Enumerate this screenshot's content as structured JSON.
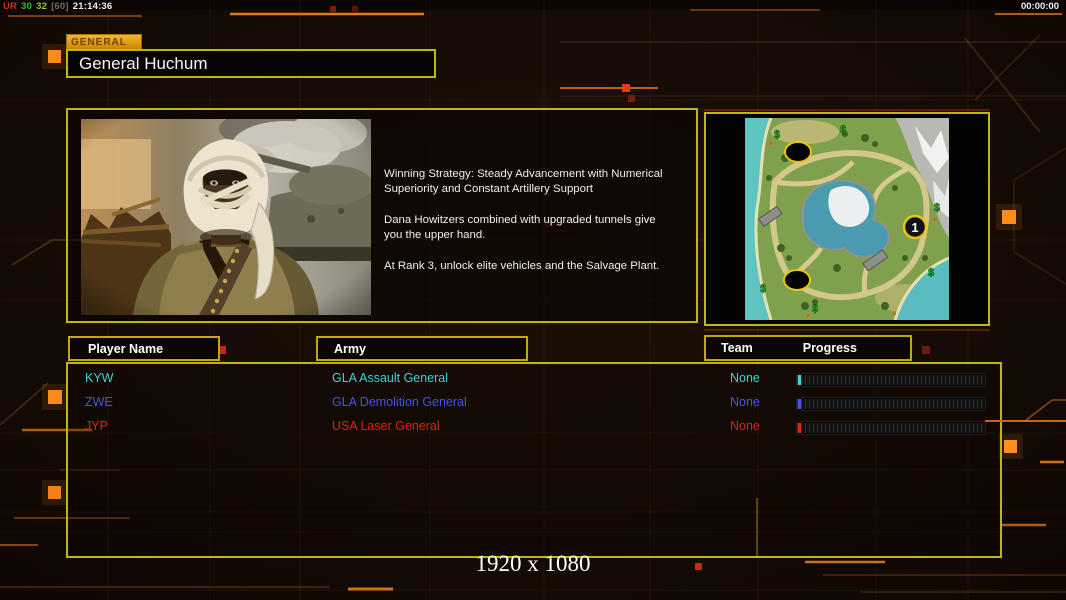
{
  "hud": {
    "fps_counter": {
      "prefix": "UR",
      "value1": "30",
      "value2": "32",
      "value3": "[60]",
      "clock": "21:14:36"
    },
    "match_timer": "00:00:00"
  },
  "general": {
    "tab_label": "GENERAL",
    "name": "General Huchum"
  },
  "strategy": {
    "text": "Winning Strategy: Steady Advancement with Numerical\n Superiority and Constant Artillery Support\n\nDana Howitzers combined with upgraded tunnels give\n you the upper hand.\n\nAt Rank 3, unlock elite vehicles and the Salvage Plant."
  },
  "map": {
    "start_marker_label": "1"
  },
  "table": {
    "headers": {
      "player_name": "Player Name",
      "army": "Army",
      "team": "Team",
      "progress": "Progress"
    },
    "rows": [
      {
        "name": "KYW",
        "army": "GLA Assault General",
        "team": "None",
        "color": "#3ed2d8"
      },
      {
        "name": "ZWE",
        "army": "GLA Demolition General",
        "team": "None",
        "color": "#4554ef"
      },
      {
        "name": "JYP",
        "army": "USA Laser General",
        "team": "None",
        "color": "#e32114"
      }
    ]
  },
  "footer": {
    "resolution": "1920 x 1080"
  },
  "colors": {
    "border_yellow": "#bdb70e",
    "accent_orange": "#e87818",
    "fps_prefix": "#d03018",
    "fps_value1": "#28c028",
    "fps_value2": "#9cc81e",
    "fps_value3": "#6f6f57",
    "fps_clock": "#f2f2f2",
    "timer": "#f2f2f2"
  }
}
